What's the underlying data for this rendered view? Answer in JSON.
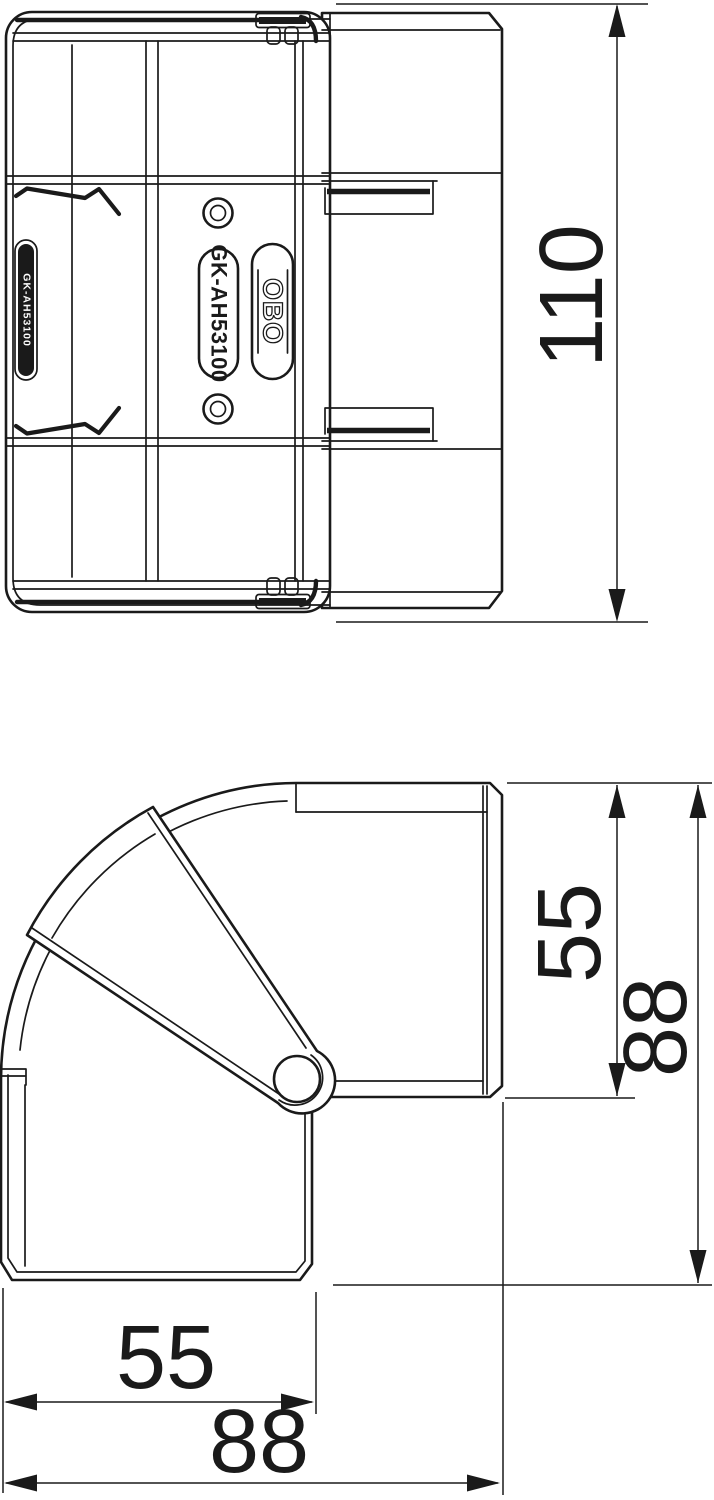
{
  "product": {
    "model_label": "GK-AH53100",
    "brand_logo": "OBO",
    "side_marking": "GK-AH53100"
  },
  "dimensions": {
    "plan_overall_length": "110",
    "side_lid_height": "55",
    "side_overall_height": "88",
    "side_duct_width": "55",
    "side_overall_width": "88"
  },
  "colors": {
    "line_color": "#1a1a1a",
    "background": "#ffffff"
  }
}
